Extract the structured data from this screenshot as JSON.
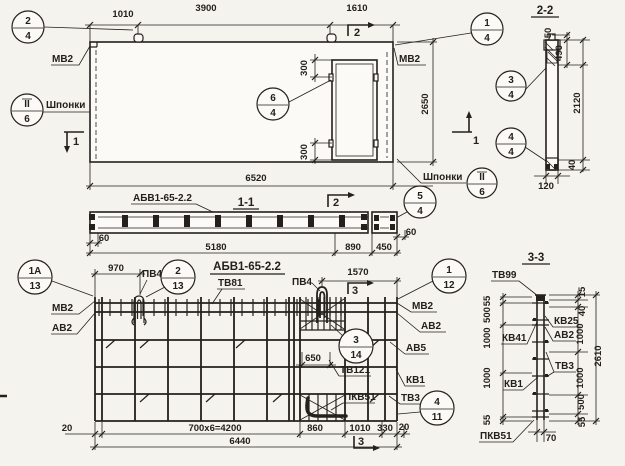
{
  "drawing": {
    "plan": {
      "dims": {
        "top_left": "1010",
        "top_mid": "3900",
        "top_right": "1610",
        "height": "2650",
        "total": "6520",
        "opening_top": "300",
        "opening_bottom": "300"
      },
      "labels": {
        "mv2_left": "МВ2",
        "mv2_right": "МВ2",
        "keys_left": "Шпонки",
        "keys_right": "Шпонки"
      },
      "cuts": {
        "top": "2",
        "left": "1",
        "right": "1"
      },
      "callouts": {
        "c24_top": "2",
        "c24_bot": "4",
        "c14_top": "1",
        "c14_bot": "4",
        "c64_top": "6",
        "c64_bot": "4",
        "c54_top": "5",
        "c54_bot": "4",
        "node_l_top": "II",
        "node_l_bot": "6",
        "node_r_top": "II",
        "node_r_bot": "6"
      }
    },
    "s22": {
      "title": "2-2",
      "d50": "50",
      "d490": "490",
      "d2120": "2120",
      "d40": "40",
      "d120": "120",
      "c34_top": "3",
      "c34_bot": "4",
      "c44_top": "4",
      "c44_bot": "4"
    },
    "s11": {
      "title": "1-1",
      "mark": "АБВ1-65-2.2",
      "cut": "2",
      "d60l": "60",
      "d5180": "5180",
      "d890": "890",
      "d450": "450",
      "d60r": "60"
    },
    "cage": {
      "title": "АБВ1-65-2.2",
      "tv81": "ТВ81",
      "pv4_a": "ПВ4",
      "pv4_b": "ПВ4",
      "mv2_l": "МВ2",
      "av2_l": "АВ2",
      "mv2_r": "МВ2",
      "av2_r": "АВ2",
      "av5": "АВ5",
      "tv121": "ТВ121",
      "kv1": "КВ1",
      "pkv51": "ПКВ51",
      "tv3": "ТВ3",
      "d970": "970",
      "d1570": "1570",
      "d650": "650",
      "d20l": "20",
      "dmain": "700х6=4200",
      "d860": "860",
      "d1010": "1010",
      "d330": "330",
      "d20r": "20",
      "d6440": "6440",
      "cut_top": "3",
      "cut_bot": "3",
      "c1a13_top": "1А",
      "c1a13_bot": "13",
      "c213_top": "2",
      "c213_bot": "13",
      "c112_top": "1",
      "c112_bot": "12",
      "c314_top": "3",
      "c314_bot": "14",
      "c411_top": "4",
      "c411_bot": "11"
    },
    "s33": {
      "title": "3-3",
      "tv99": "ТВ99",
      "kv25": "КВ25",
      "av2": "АВ2",
      "kv41": "КВ41",
      "tv3": "ТВ3",
      "kv1": "КВ1",
      "pkv51": "ПКВ51",
      "left": [
        "55",
        "500",
        "1000",
        "1000",
        "55"
      ],
      "right": [
        "15",
        "40",
        "1000",
        "1000",
        "500",
        "55"
      ],
      "total": "2610",
      "d70": "70"
    }
  }
}
